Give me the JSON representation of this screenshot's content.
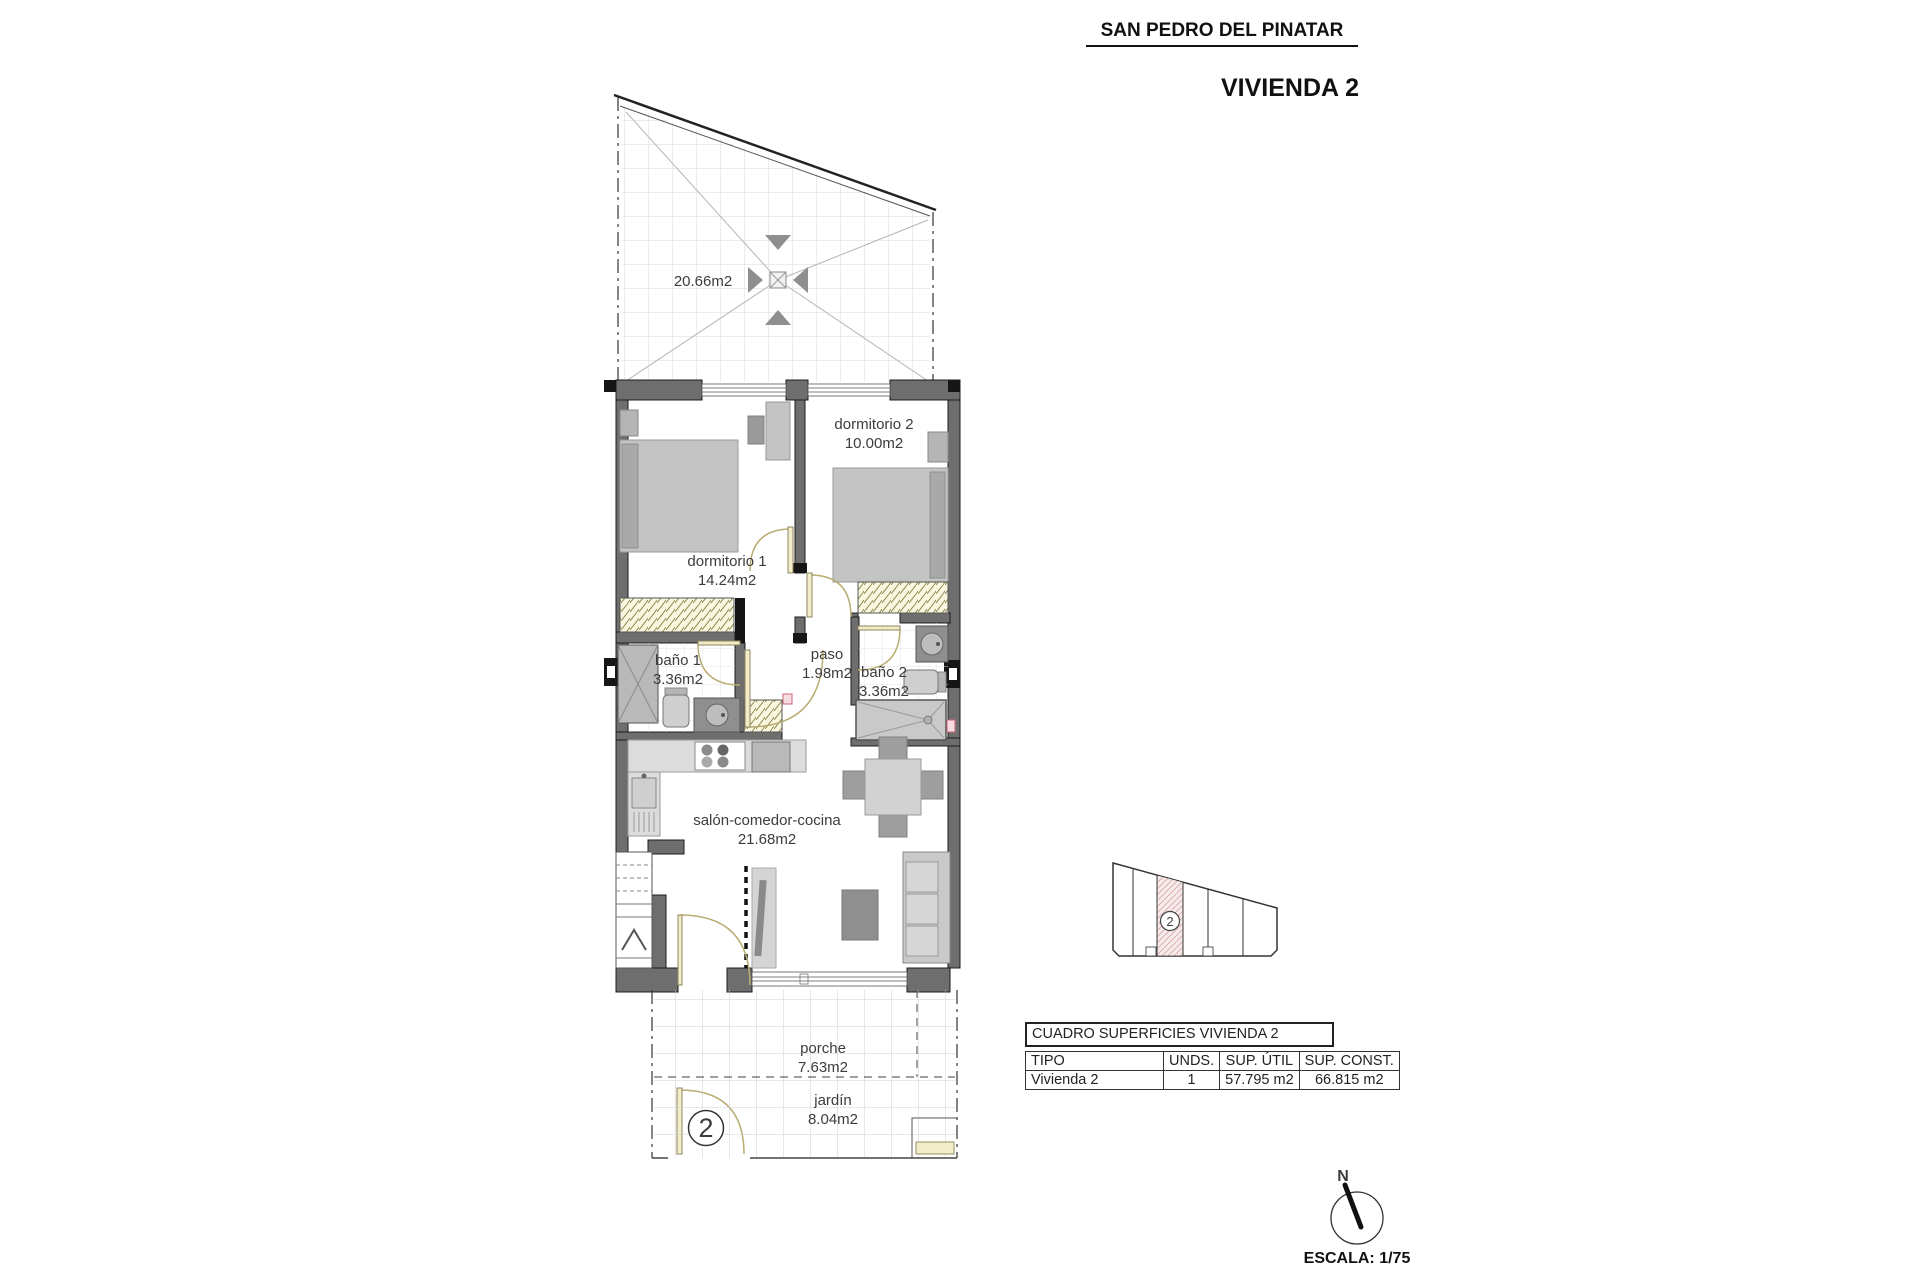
{
  "header": {
    "location": "SAN PEDRO DEL PINATAR",
    "unit_title": "VIVIENDA 2"
  },
  "plan": {
    "roof_terrace": {
      "area": "20.66m2"
    },
    "rooms": [
      {
        "id": "dormitorio1",
        "name": "dormitorio 1",
        "area": "14.24m2"
      },
      {
        "id": "dormitorio2",
        "name": "dormitorio 2",
        "area": "10.00m2"
      },
      {
        "id": "bano1",
        "name": "baño 1",
        "area": "3.36m2"
      },
      {
        "id": "paso",
        "name": "paso",
        "area": "1.98m2"
      },
      {
        "id": "bano2",
        "name": "baño 2",
        "area": "3.36m2"
      },
      {
        "id": "salon",
        "name": "salón-comedor-cocina",
        "area": "21.68m2"
      },
      {
        "id": "porche",
        "name": "porche",
        "area": "7.63m2"
      },
      {
        "id": "jardin",
        "name": "jardín",
        "area": "8.04m2"
      }
    ],
    "entrance_unit_number": "2"
  },
  "site_plan": {
    "highlighted_unit": "2"
  },
  "surfaces_table": {
    "title": "CUADRO SUPERFICIES VIVIENDA 2",
    "columns": [
      "TIPO",
      "UNDS.",
      "SUP. ÚTIL",
      "SUP. CONST."
    ],
    "rows": [
      {
        "tipo": "Vivienda 2",
        "unds": "1",
        "sup_util": "57.795 m2",
        "sup_const": "66.815 m2"
      }
    ]
  },
  "compass": {
    "north": "N"
  },
  "scale": {
    "label": "ESCALA: 1/75"
  },
  "colors": {
    "wall": "#6e6e6e",
    "wall_cap": "#161616",
    "furniture": "#c4c4c4",
    "door": "#b9ad72",
    "site_highlight": "#f7eaea",
    "grid": "#d9d9d9"
  }
}
